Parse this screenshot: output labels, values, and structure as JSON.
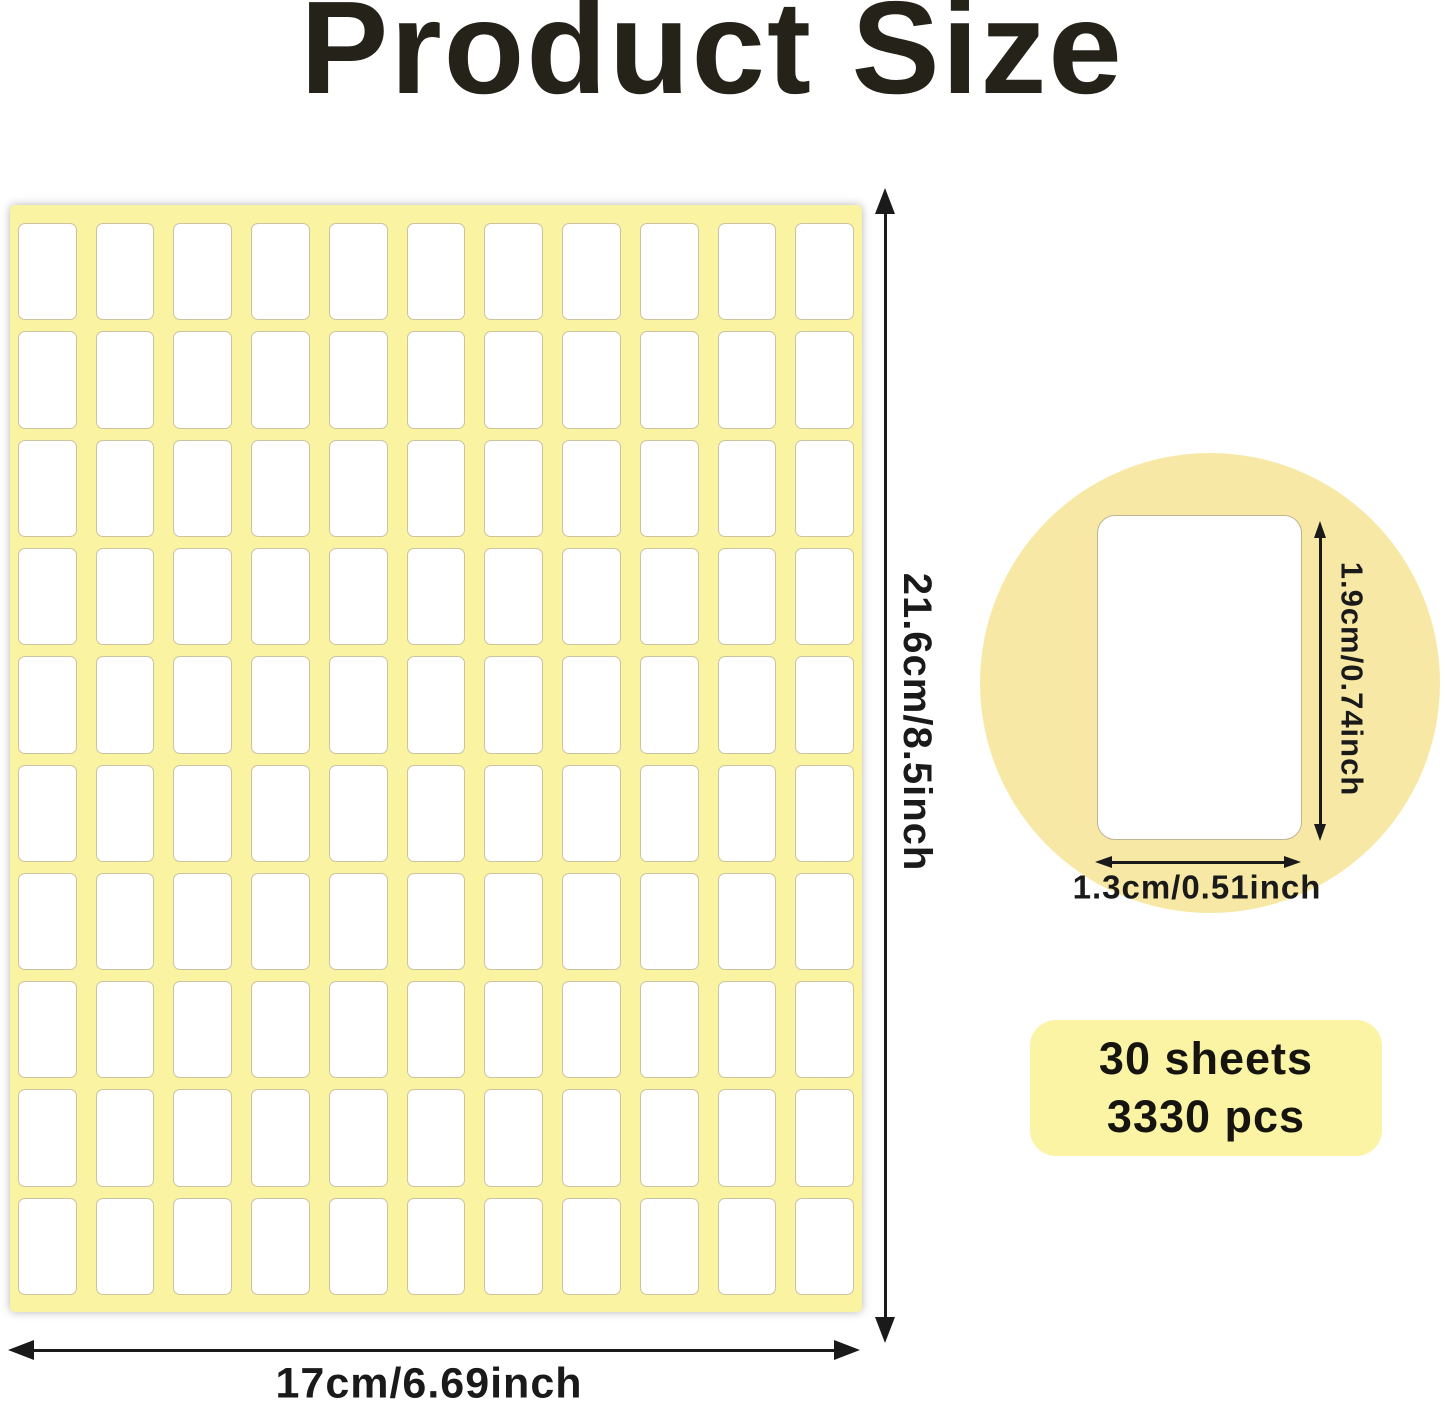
{
  "title": "Product Size",
  "sheet": {
    "columns": 11,
    "rows": 10,
    "width_label": "17cm/6.69inch",
    "height_label": "21.6cm/8.5inch"
  },
  "detail": {
    "height_label": "1.9cm/0.74inch",
    "width_label": "1.3cm/0.51inch"
  },
  "badge": {
    "line1": "30 sheets",
    "line2": "3330 pcs"
  },
  "colors": {
    "sheet_yellow": "#F9F3A2",
    "circle_yellow": "#F7E9A5",
    "badge_yellow": "#FAF4A4",
    "label_border": "#CCC4A0",
    "text_dark": "#25221A",
    "arrow_black": "#1A1A1A"
  }
}
